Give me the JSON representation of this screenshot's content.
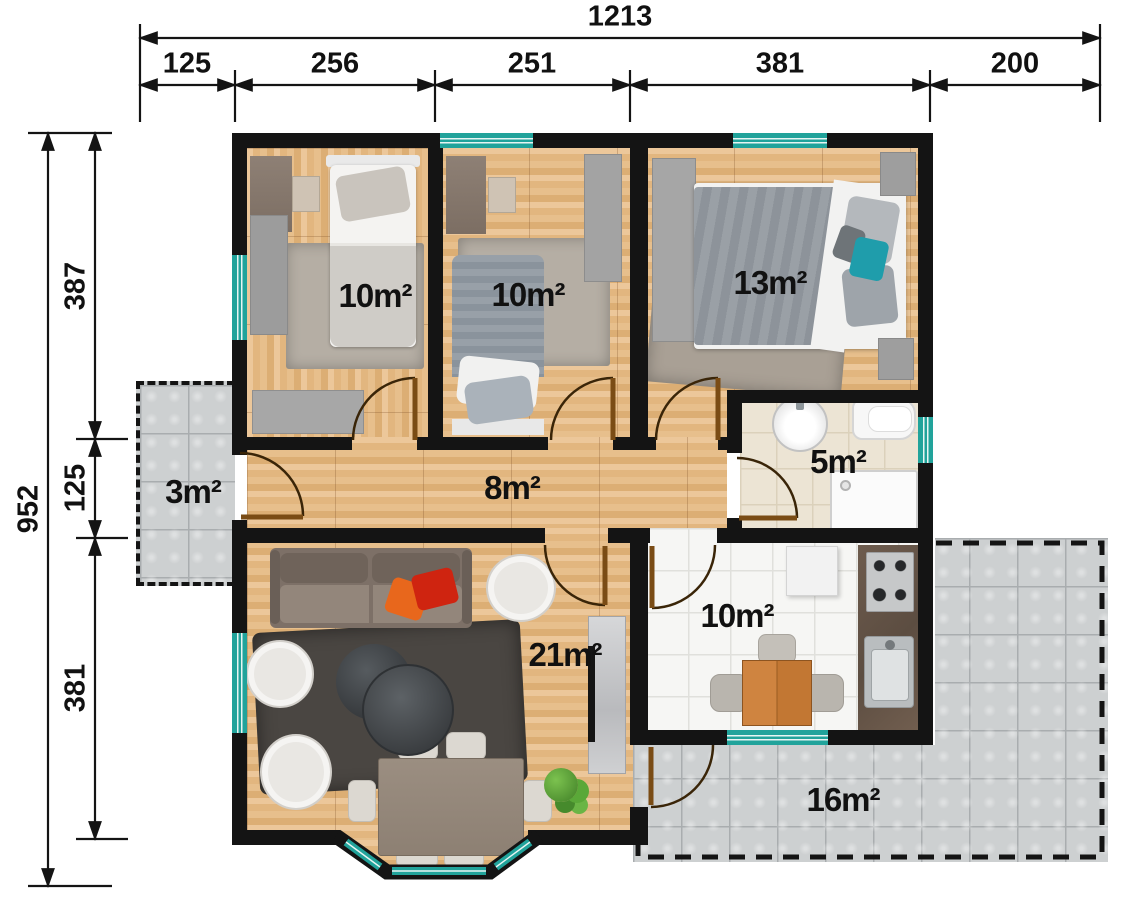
{
  "dimensions": {
    "top": {
      "total": "1213",
      "segments": [
        "125",
        "256",
        "251",
        "381",
        "200"
      ]
    },
    "left": {
      "total": "952",
      "segments": [
        "387",
        "125",
        "381"
      ]
    }
  },
  "rooms": {
    "bedroom1": {
      "area": "10m²"
    },
    "bedroom2": {
      "area": "10m²"
    },
    "bedroom3": {
      "area": "13m²"
    },
    "porch": {
      "area": "3m²"
    },
    "hallway": {
      "area": "8m²"
    },
    "bathroom": {
      "area": "5m²"
    },
    "living": {
      "area": "21m²"
    },
    "kitchen": {
      "area": "10m²"
    },
    "terrace": {
      "area": "16m²"
    }
  },
  "colors": {
    "wall": "#141414",
    "window": "#21a39b",
    "wood": "#e5ba85",
    "tile_white": "#f6f6f4",
    "tile_beige": "#ece4d4",
    "concrete": "#cdd0d1",
    "rug_light": "#b5aea4",
    "rug_dark": "#4a4642",
    "sofa": "#7d7067",
    "accent_orange": "#e8671c",
    "accent_red": "#cf2410",
    "pillow_teal": "#1f9dab",
    "door_leaf": "#7a4c15",
    "counter": "#5c4d41"
  }
}
